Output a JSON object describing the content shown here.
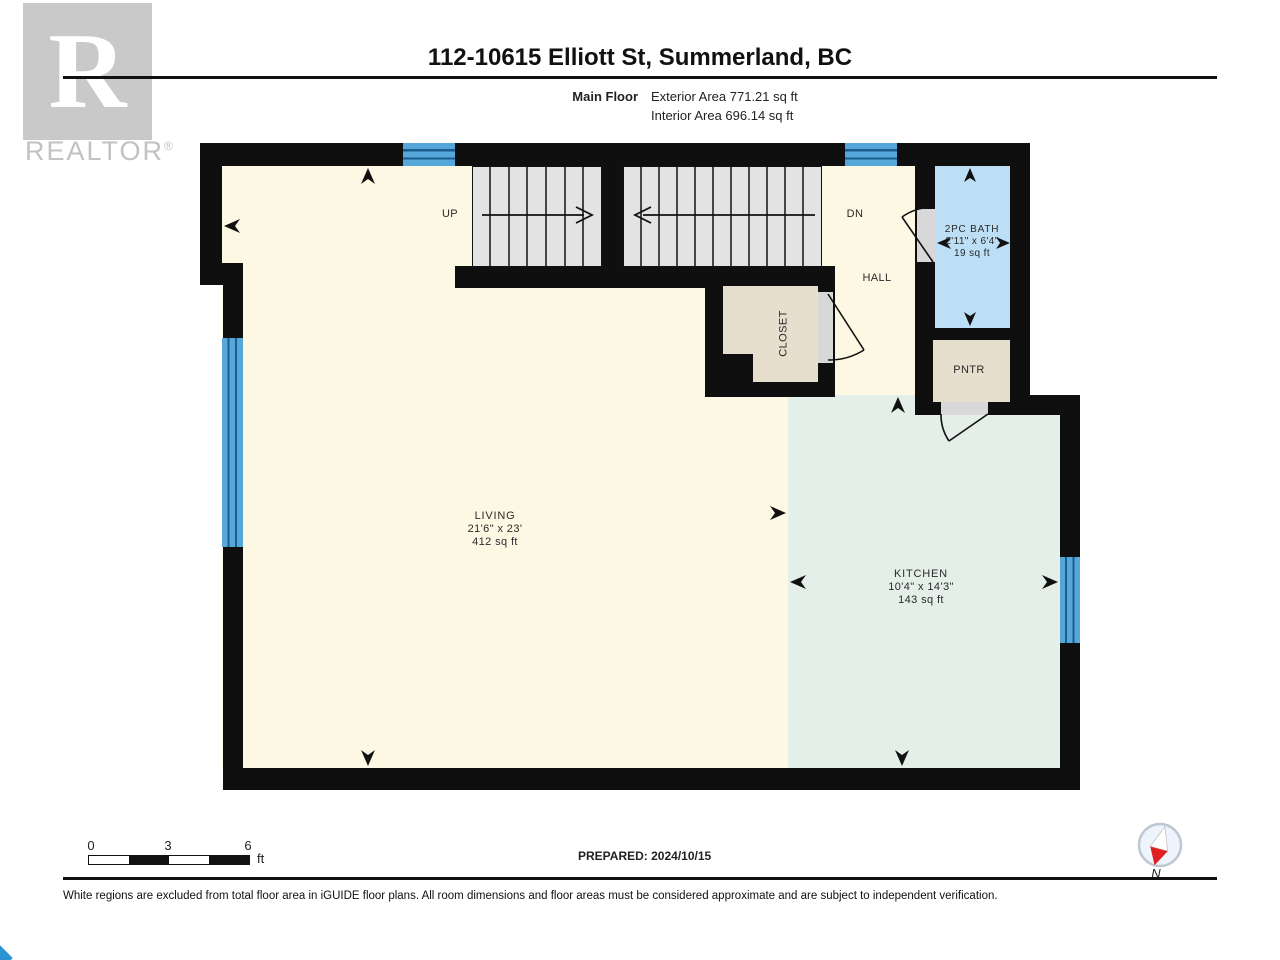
{
  "header": {
    "title": "112-10615 Elliott St, Summerland, BC",
    "floor_label": "Main Floor",
    "exterior_area": "Exterior Area 771.21 sq ft",
    "interior_area": "Interior Area 696.14 sq ft"
  },
  "watermark": {
    "letter": "R",
    "text": "REALTOR",
    "registered": "®"
  },
  "rooms": {
    "living": {
      "name": "LIVING",
      "dims": "21'6\" x 23'",
      "area": "412 sq ft"
    },
    "kitchen": {
      "name": "KITCHEN",
      "dims": "10'4\" x 14'3\"",
      "area": "143 sq ft"
    },
    "bath": {
      "name": "2PC BATH",
      "dims": "2'11\" x 6'4\"",
      "area": "19 sq ft"
    },
    "closet": {
      "name": "CLOSET"
    },
    "pantry": {
      "name": "PNTR"
    },
    "hall": {
      "name": "HALL"
    },
    "stair_up_label": "UP",
    "stair_down_label": "DN"
  },
  "footer": {
    "scale_ticks": [
      "0",
      "3",
      "6"
    ],
    "scale_unit": "ft",
    "prepared": "PREPARED: 2024/10/15",
    "compass_label": "N",
    "disclaimer": "White regions are excluded from total floor area in iGUIDE floor plans. All room dimensions and floor areas must be considered approximate and are subject to independent verification."
  },
  "colors": {
    "floor_cream": "#fdf8e4",
    "floor_mint": "#e3efe8",
    "floor_blue": "#bcdff5",
    "floor_tan": "#e6dfce",
    "stairs_gray": "#e3e3e3",
    "window_blue": "#54a7d8",
    "wall_black": "#0f0f0f"
  }
}
